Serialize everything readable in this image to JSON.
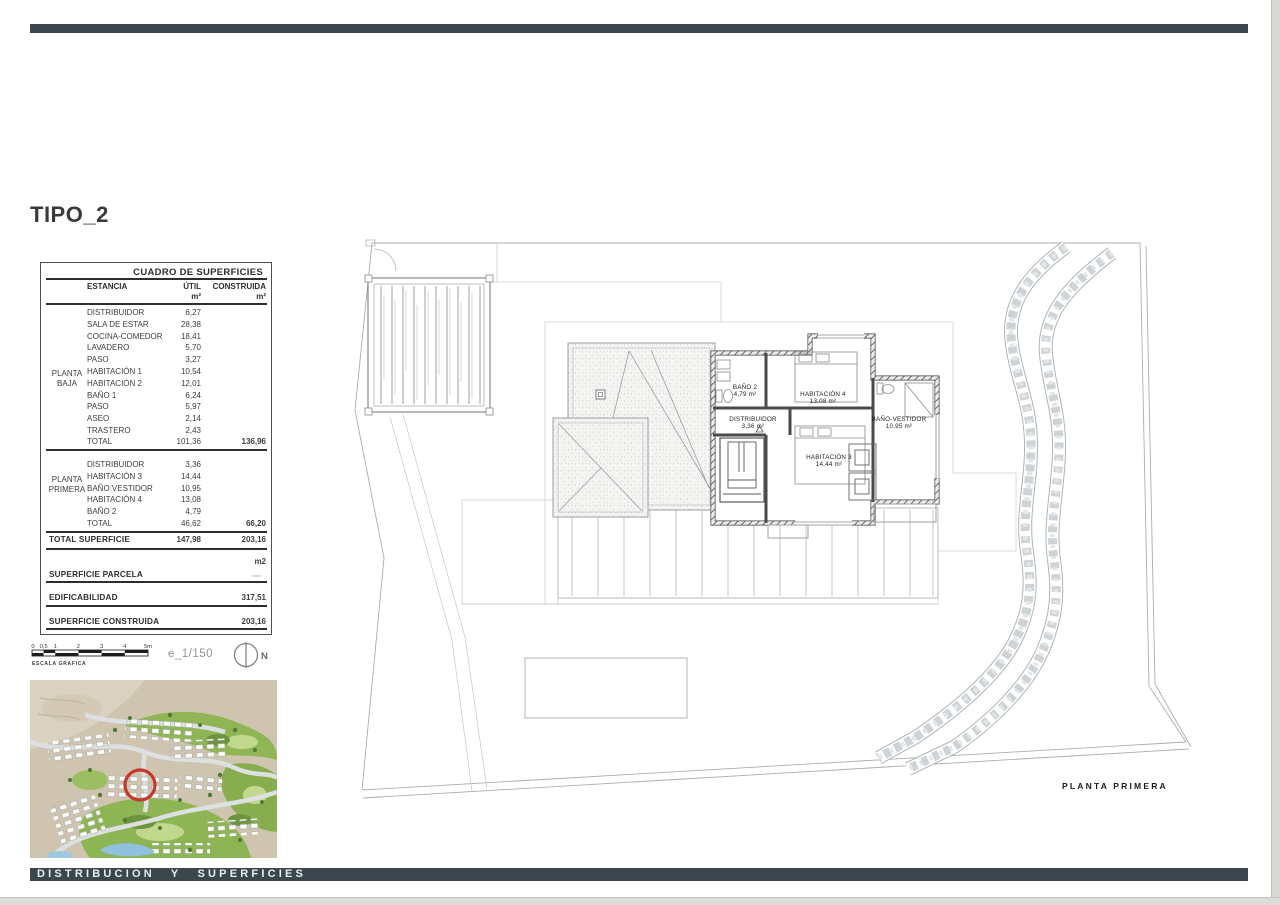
{
  "title": "TIPO_2",
  "table": {
    "title": "CUADRO DE SUPERFICIES",
    "col_estancia": "ESTANCIA",
    "col_util": "ÚTIL",
    "col_construida": "CONSTRUIDA",
    "unit": "m²",
    "groups": [
      {
        "floor_line1": "PLANTA",
        "floor_line2": "BAJA",
        "rows": [
          {
            "name": "DISTRIBUIDOR",
            "util": "6,27",
            "cons": ""
          },
          {
            "name": "SALA DE ESTAR",
            "util": "28,38",
            "cons": ""
          },
          {
            "name": "COCINA-COMEDOR",
            "util": "18,41",
            "cons": ""
          },
          {
            "name": "LAVADERO",
            "util": "5,70",
            "cons": ""
          },
          {
            "name": "PASO",
            "util": "3,27",
            "cons": ""
          },
          {
            "name": "HABITACIÓN 1",
            "util": "10,54",
            "cons": ""
          },
          {
            "name": "HABITACIÓN 2",
            "util": "12,01",
            "cons": ""
          },
          {
            "name": "BAÑO 1",
            "util": "6,24",
            "cons": ""
          },
          {
            "name": "PASO",
            "util": "5,97",
            "cons": ""
          },
          {
            "name": "ASEO",
            "util": "2,14",
            "cons": ""
          },
          {
            "name": "TRASTERO",
            "util": "2,43",
            "cons": ""
          }
        ],
        "total": {
          "label": "TOTAL",
          "util": "101,36",
          "cons": "136,96"
        }
      },
      {
        "floor_line1": "PLANTA",
        "floor_line2": "PRIMERA",
        "rows": [
          {
            "name": "DISTRIBUIDOR",
            "util": "3,36",
            "cons": ""
          },
          {
            "name": "HABITACIÓN 3",
            "util": "14,44",
            "cons": ""
          },
          {
            "name": "BAÑO VESTIDOR",
            "util": "10,95",
            "cons": ""
          },
          {
            "name": "HABITACIÓN 4",
            "util": "13,08",
            "cons": ""
          },
          {
            "name": "BAÑO 2",
            "util": "4,79",
            "cons": ""
          }
        ],
        "total": {
          "label": "TOTAL",
          "util": "46,62",
          "cons": "66,20"
        }
      }
    ],
    "total_superficie": {
      "label": "TOTAL SUPERFICIE",
      "util": "147,98",
      "cons": "203,16"
    },
    "unit_note": "m2",
    "summary": [
      {
        "label": "SUPERFICIE PARCELA",
        "value": ""
      },
      {
        "label": "EDIFICABILIDAD",
        "value": "317,51"
      },
      {
        "label": "SUPERFICIE CONSTRUIDA",
        "value": "203,16"
      }
    ]
  },
  "scale": {
    "ticks": [
      "0",
      "0,5",
      "1",
      "2",
      "3",
      "4",
      "5m"
    ],
    "caption": "ESCALA GRAFICA",
    "ratio_label": "e_1/150",
    "north_label": "N"
  },
  "plan": {
    "rooms": [
      {
        "name": "BAÑO 2",
        "area": "4,79 m²"
      },
      {
        "name": "HABITACIÓN 4",
        "area": "13,08 m²"
      },
      {
        "name": "DISTRIBUIDOR",
        "area": "3,36 m²"
      },
      {
        "name": "BAÑO-VESTIDOR",
        "area": "10,95 m²"
      },
      {
        "name": "HABITACIÓN 3",
        "area": "14,44 m²"
      }
    ],
    "caption": "PLANTA PRIMERA"
  },
  "footer": {
    "text": "DISTRIBUCIÓN Y SUPERFICIES"
  },
  "colors": {
    "bar": "#3c474d",
    "marker_red": "#c5392d",
    "wall": "#454545",
    "plot_line": "#a8adb1"
  }
}
